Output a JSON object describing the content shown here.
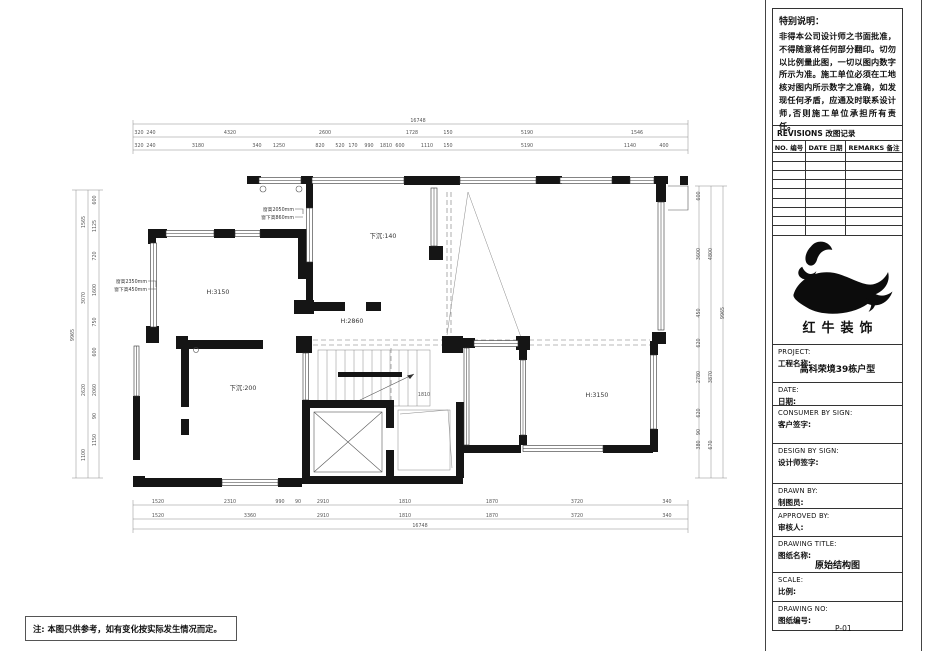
{
  "sheet": {
    "note_bottom_left": "注: 本图只供参考，如有变化按实际发生情况而定。",
    "special_note": {
      "title": "特别说明：",
      "body": "非得本公司设计师之书面批准，不得随意将任何部分翻印。切勿以比例量此图，一切以图内数字所示为准。施工单位必须在工地核对图内所示数字之准确，如发现任何矛盾，应通及时联系设计师,否则施工单位承担所有责任。"
    },
    "revisions": {
      "title": "REVISIONS 改图记录",
      "columns": [
        "NO. 编号",
        "DATE 日期",
        "REMARKS 备注"
      ],
      "empty_rows": 9
    },
    "logo": {
      "name": "红牛装饰"
    },
    "project": {
      "en": "PROJECT:",
      "cn": "工程名称:",
      "value": "高科荣境39栋户型"
    },
    "date": {
      "en": "DATE:",
      "cn": "日期:"
    },
    "consumer": {
      "en": "CONSUMER BY SIGN:",
      "cn": "客户签字:"
    },
    "design": {
      "en": "DESIGN BY SIGN:",
      "cn": "设计师签字:"
    },
    "drawn": {
      "en": "DRAWN BY:",
      "cn": "制图员:"
    },
    "approved": {
      "en": "APPROVED BY:",
      "cn": "审核人:"
    },
    "title_field": {
      "en": "DRAWING TITLE:",
      "cn": "图纸名称:",
      "value": "原始结构图"
    },
    "scale": {
      "en": "SCALE:",
      "cn": "比例:"
    },
    "number": {
      "en": "DRAWING NO:",
      "cn": "图纸编号:",
      "value": "P-01"
    }
  },
  "floor_plan": {
    "labels": [
      {
        "t": "16748",
        "x": 418,
        "y": 122,
        "c": "dim"
      },
      {
        "t": "320",
        "x": 139,
        "y": 134,
        "c": "dim"
      },
      {
        "t": "240",
        "x": 151,
        "y": 134,
        "c": "dim"
      },
      {
        "t": "4320",
        "x": 230,
        "y": 134,
        "c": "dim"
      },
      {
        "t": "2600",
        "x": 325,
        "y": 134,
        "c": "dim"
      },
      {
        "t": "1728",
        "x": 412,
        "y": 134,
        "c": "dim"
      },
      {
        "t": "150",
        "x": 448,
        "y": 134,
        "c": "dim"
      },
      {
        "t": "5190",
        "x": 527,
        "y": 134,
        "c": "dim"
      },
      {
        "t": "1546",
        "x": 637,
        "y": 134,
        "c": "dim"
      },
      {
        "t": "320",
        "x": 139,
        "y": 147,
        "c": "dim"
      },
      {
        "t": "240",
        "x": 151,
        "y": 147,
        "c": "dim"
      },
      {
        "t": "3180",
        "x": 198,
        "y": 147,
        "c": "dim"
      },
      {
        "t": "340",
        "x": 257,
        "y": 147,
        "c": "dim"
      },
      {
        "t": "1250",
        "x": 279,
        "y": 147,
        "c": "dim"
      },
      {
        "t": "820",
        "x": 320,
        "y": 147,
        "c": "dim"
      },
      {
        "t": "520",
        "x": 340,
        "y": 147,
        "c": "dim"
      },
      {
        "t": "170",
        "x": 353,
        "y": 147,
        "c": "dim"
      },
      {
        "t": "990",
        "x": 369,
        "y": 147,
        "c": "dim"
      },
      {
        "t": "1810",
        "x": 386,
        "y": 147,
        "c": "dim"
      },
      {
        "t": "600",
        "x": 400,
        "y": 147,
        "c": "dim"
      },
      {
        "t": "1110",
        "x": 427,
        "y": 147,
        "c": "dim"
      },
      {
        "t": "150",
        "x": 448,
        "y": 147,
        "c": "dim"
      },
      {
        "t": "5190",
        "x": 527,
        "y": 147,
        "c": "dim"
      },
      {
        "t": "1140",
        "x": 630,
        "y": 147,
        "c": "dim"
      },
      {
        "t": "400",
        "x": 664,
        "y": 147,
        "c": "dim"
      },
      {
        "t": "1520",
        "x": 158,
        "y": 503,
        "c": "dim"
      },
      {
        "t": "2310",
        "x": 230,
        "y": 503,
        "c": "dim"
      },
      {
        "t": "990",
        "x": 280,
        "y": 503,
        "c": "dim"
      },
      {
        "t": "90",
        "x": 298,
        "y": 503,
        "c": "dim"
      },
      {
        "t": "2910",
        "x": 323,
        "y": 503,
        "c": "dim"
      },
      {
        "t": "1810",
        "x": 405,
        "y": 503,
        "c": "dim"
      },
      {
        "t": "1870",
        "x": 492,
        "y": 503,
        "c": "dim"
      },
      {
        "t": "3720",
        "x": 577,
        "y": 503,
        "c": "dim"
      },
      {
        "t": "340",
        "x": 667,
        "y": 503,
        "c": "dim"
      },
      {
        "t": "1520",
        "x": 158,
        "y": 517,
        "c": "dim"
      },
      {
        "t": "3360",
        "x": 250,
        "y": 517,
        "c": "dim"
      },
      {
        "t": "2910",
        "x": 323,
        "y": 517,
        "c": "dim"
      },
      {
        "t": "1810",
        "x": 405,
        "y": 517,
        "c": "dim"
      },
      {
        "t": "1870",
        "x": 492,
        "y": 517,
        "c": "dim"
      },
      {
        "t": "3720",
        "x": 577,
        "y": 517,
        "c": "dim"
      },
      {
        "t": "340",
        "x": 667,
        "y": 517,
        "c": "dim"
      },
      {
        "t": "16748",
        "x": 420,
        "y": 527,
        "c": "dim"
      },
      {
        "t": "9965",
        "x": 74,
        "y": 335,
        "r": -90,
        "c": "dim"
      },
      {
        "t": "1565",
        "x": 85,
        "y": 222,
        "r": -90,
        "c": "dim"
      },
      {
        "t": "3070",
        "x": 85,
        "y": 298,
        "r": -90,
        "c": "dim"
      },
      {
        "t": "2620",
        "x": 85,
        "y": 390,
        "r": -90,
        "c": "dim"
      },
      {
        "t": "1100",
        "x": 85,
        "y": 455,
        "r": -90,
        "c": "dim"
      },
      {
        "t": "600",
        "x": 96,
        "y": 200,
        "r": -90,
        "c": "dim"
      },
      {
        "t": "1125",
        "x": 96,
        "y": 226,
        "r": -90,
        "c": "dim"
      },
      {
        "t": "720",
        "x": 96,
        "y": 256,
        "r": -90,
        "c": "dim"
      },
      {
        "t": "1600",
        "x": 96,
        "y": 290,
        "r": -90,
        "c": "dim"
      },
      {
        "t": "750",
        "x": 96,
        "y": 322,
        "r": -90,
        "c": "dim"
      },
      {
        "t": "600",
        "x": 96,
        "y": 352,
        "r": -90,
        "c": "dim"
      },
      {
        "t": "2060",
        "x": 96,
        "y": 390,
        "r": -90,
        "c": "dim"
      },
      {
        "t": "90",
        "x": 96,
        "y": 416,
        "r": -90,
        "c": "dim"
      },
      {
        "t": "1150",
        "x": 96,
        "y": 440,
        "r": -90,
        "c": "dim"
      },
      {
        "t": "9965",
        "x": 724,
        "y": 313,
        "r": -90,
        "c": "dim"
      },
      {
        "t": "600",
        "x": 700,
        "y": 196,
        "r": -90,
        "c": "dim"
      },
      {
        "t": "3600",
        "x": 700,
        "y": 254,
        "r": -90,
        "c": "dim"
      },
      {
        "t": "450",
        "x": 700,
        "y": 313,
        "r": -90,
        "c": "dim"
      },
      {
        "t": "620",
        "x": 700,
        "y": 343,
        "r": -90,
        "c": "dim"
      },
      {
        "t": "2780",
        "x": 700,
        "y": 377,
        "r": -90,
        "c": "dim"
      },
      {
        "t": "620",
        "x": 700,
        "y": 413,
        "r": -90,
        "c": "dim"
      },
      {
        "t": "90",
        "x": 700,
        "y": 432,
        "r": -90,
        "c": "dim"
      },
      {
        "t": "380",
        "x": 700,
        "y": 445,
        "r": -90,
        "c": "dim"
      },
      {
        "t": "4800",
        "x": 712,
        "y": 254,
        "r": -90,
        "c": "dim"
      },
      {
        "t": "3870",
        "x": 712,
        "y": 377,
        "r": -90,
        "c": "dim"
      },
      {
        "t": "670",
        "x": 712,
        "y": 445,
        "r": -90,
        "c": "dim"
      },
      {
        "t": "H:3150",
        "x": 218,
        "y": 294,
        "c": "room"
      },
      {
        "t": "下沉:140",
        "x": 383,
        "y": 238,
        "c": "room"
      },
      {
        "t": "H:2860",
        "x": 352,
        "y": 323,
        "c": "room"
      },
      {
        "t": "下沉:200",
        "x": 243,
        "y": 390,
        "c": "room"
      },
      {
        "t": "H:3150",
        "x": 597,
        "y": 397,
        "c": "room"
      },
      {
        "t": "1810",
        "x": 424,
        "y": 396,
        "c": "dim"
      },
      {
        "t": "窗高2050mm",
        "x": 294,
        "y": 211,
        "c": "note"
      },
      {
        "t": "窗下高860mm",
        "x": 294,
        "y": 219,
        "c": "note"
      },
      {
        "t": "窗高2350mm",
        "x": 147,
        "y": 283,
        "c": "note"
      },
      {
        "t": "窗下高450mm",
        "x": 147,
        "y": 291,
        "c": "note"
      }
    ]
  }
}
